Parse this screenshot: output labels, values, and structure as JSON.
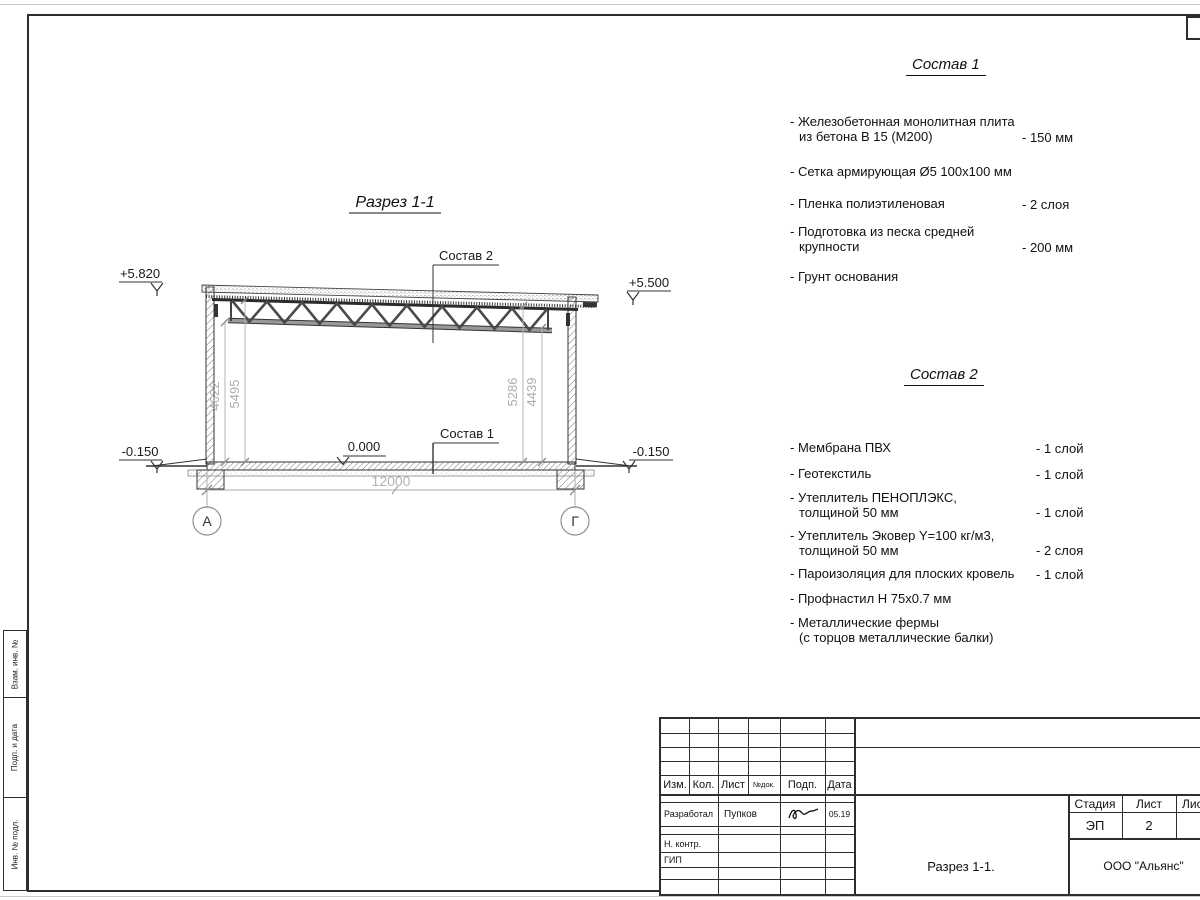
{
  "section": {
    "title": "Разрез 1-1",
    "labels": {
      "sostav2_ref": "Состав 2",
      "sostav1_ref": "Состав 1",
      "elev_top_left": "+5.820",
      "elev_top_right": "+5.500",
      "elev_zero": "0.000",
      "elev_bottom_left": "-0.150",
      "elev_bottom_right": "-0.150",
      "dim_span": "12000",
      "dim_left_inner": "4622",
      "dim_left_outer": "5495",
      "dim_right_inner": "5286",
      "dim_right_outer": "4439",
      "axis_left": "А",
      "axis_right": "Г"
    }
  },
  "sostav1": {
    "title": "Состав 1",
    "items": [
      {
        "line1": "- Железобетонная  монолитная плита",
        "line2": "из бетона В 15 (М200)",
        "value": "- 150 мм"
      },
      {
        "line1": "- Сетка армирующая Ø5 100х100 мм",
        "line2": "",
        "value": ""
      },
      {
        "line1": "- Пленка полиэтиленовая",
        "line2": "",
        "value": "-  2 слоя"
      },
      {
        "line1": "- Подготовка из песка средней",
        "line2": "крупности",
        "value": "- 200 мм"
      },
      {
        "line1": "- Грунт основания",
        "line2": "",
        "value": ""
      }
    ]
  },
  "sostav2": {
    "title": "Состав 2",
    "items": [
      {
        "line1": "- Мембрана ПВХ",
        "line2": "",
        "value": "- 1 слой"
      },
      {
        "line1": "- Геотекстиль",
        "line2": "",
        "value": "- 1 слой"
      },
      {
        "line1": "- Утеплитель ПЕНОПЛЭКС,",
        "line2": "толщиной 50 мм",
        "value": "- 1 слой"
      },
      {
        "line1": "- Утеплитель Эковер Y=100 кг/м3,",
        "line2": "толщиной 50 мм",
        "value": "- 2 слоя"
      },
      {
        "line1": "- Пароизоляция для плоских кровель",
        "line2": "",
        "value": "- 1 слой"
      },
      {
        "line1": "- Профнастил Н 75х0.7 мм",
        "line2": "",
        "value": ""
      },
      {
        "line1": "- Металлические фермы",
        "line2": "(с торцов металлические балки)",
        "value": ""
      }
    ]
  },
  "titleblock": {
    "header": {
      "izm": "Изм.",
      "kol": "Кол.",
      "list": "Лист",
      "ndok": "№док.",
      "podp": "Подп.",
      "data": "Дата"
    },
    "rows": {
      "razrabotal": "Разработал",
      "razrabotal_name": "Пупков",
      "razrabotal_date": "05.19",
      "nkontr": "Н. контр.",
      "gip": "ГИП"
    },
    "stadia_label": "Стадия",
    "stadia_value": "ЭП",
    "list_label": "Лист",
    "list_value": "2",
    "listov_label": "Листов",
    "listov_value": "",
    "doc_title": "Разрез 1-1.",
    "company": "ООО \"Альянс\""
  },
  "frame": {
    "side_boxes": [
      "Взам. инв. №",
      "Подп. и дата",
      "Инв. № подл."
    ]
  }
}
